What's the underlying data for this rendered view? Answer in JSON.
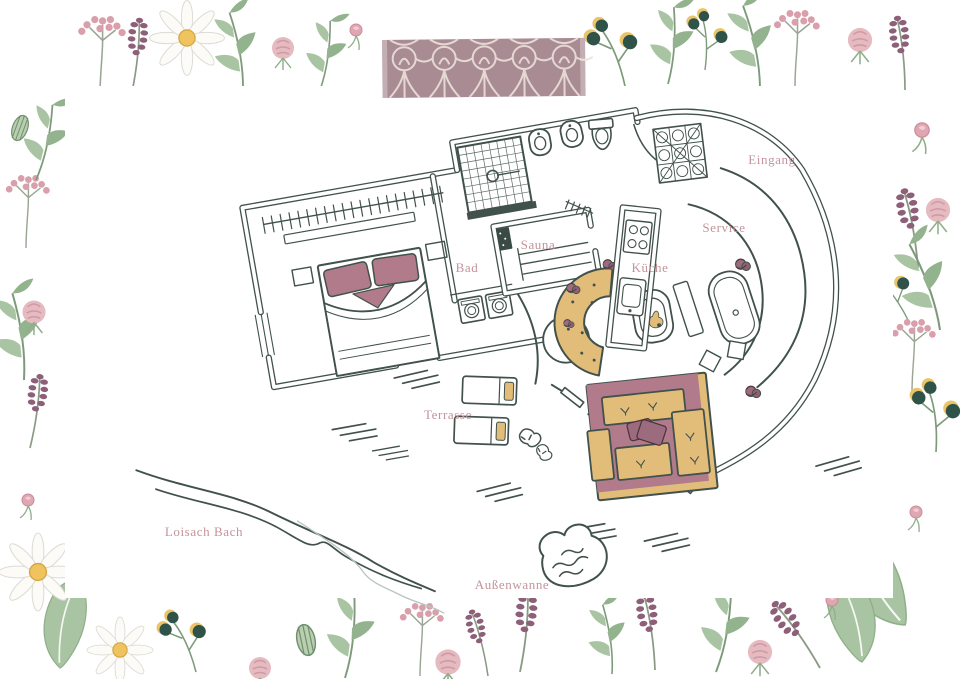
{
  "illustration": {
    "labels": {
      "entrance": "Eingang",
      "service": "Service",
      "kitchen": "Küche",
      "sauna": "Sauna",
      "bath": "Bad",
      "terrace": "Terrasse",
      "stream": "Loisach Bach",
      "outdoor_tub": "Außenwanne"
    },
    "palette": {
      "ink": "#41514b",
      "label_rose": "#c4939c",
      "furniture_tan": "#e2bd7a",
      "accent_mauve": "#b17b8b",
      "accent_mauve_deep": "#9c6b7d",
      "tape_base": "#a5868f",
      "tape_pattern": "#ece1da",
      "leaf_green": "#a9c4a2",
      "leaf_green_deep": "#93b38e",
      "flower_pink": "#e5bac0",
      "flower_pink_deep": "#d9a0ac",
      "lavender": "#8d5f79",
      "berry_dark": "#2f5348",
      "daisy_center": "#efc35d",
      "stream_echo": "#b9c4bf"
    }
  }
}
